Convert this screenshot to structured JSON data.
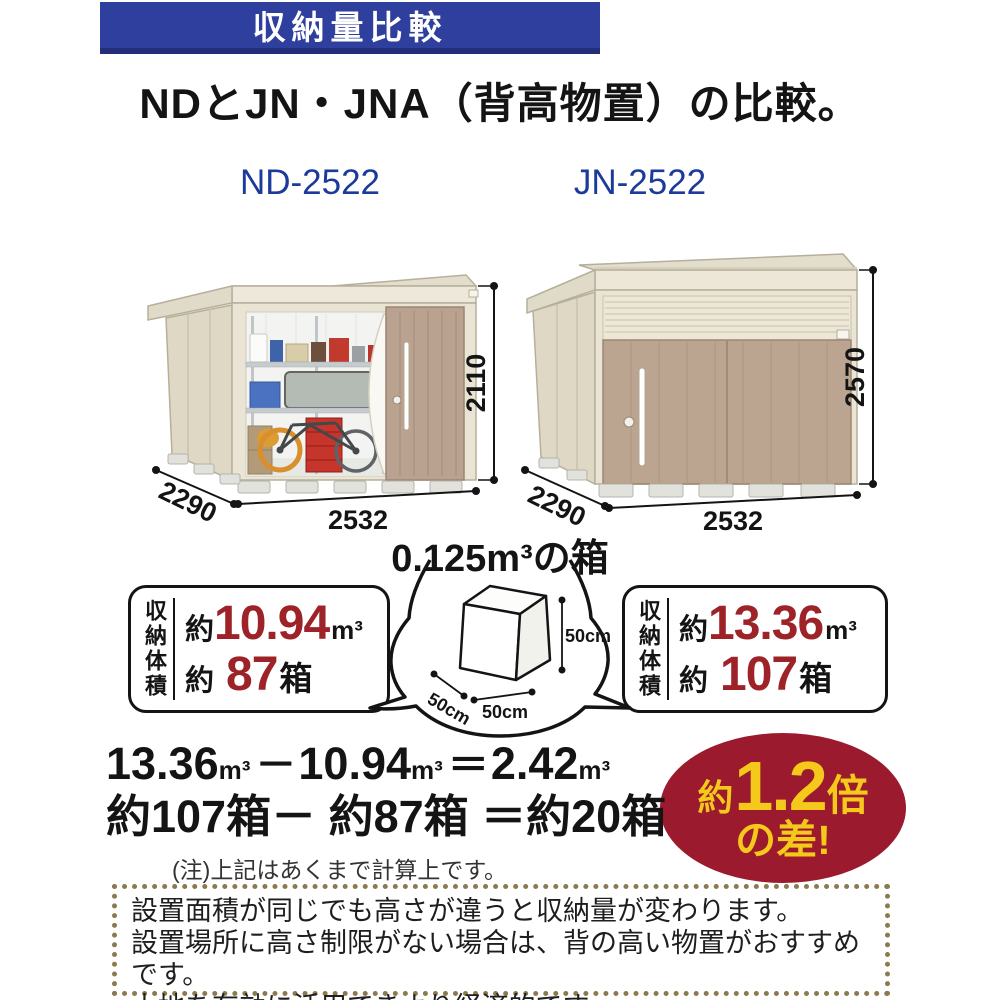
{
  "banner": {
    "title": "収納量比較"
  },
  "heading": "NDとJN・JNA（背高物置）の比較。",
  "products": {
    "nd": {
      "model": "ND-2522",
      "width": "2532",
      "depth": "2290",
      "height": "2110",
      "stat_label": "収納体積",
      "volume": {
        "approx": "約",
        "value": "10.94",
        "unit": "m³"
      },
      "boxes": {
        "approx": "約",
        "value": "87",
        "unit": "箱"
      }
    },
    "jn": {
      "model": "JN-2522",
      "width": "2532",
      "depth": "2290",
      "height": "2570",
      "stat_label": "収納体積",
      "volume": {
        "approx": "約",
        "value": "13.36",
        "unit": "m³"
      },
      "boxes": {
        "approx": "約",
        "value": "107",
        "unit": "箱"
      }
    }
  },
  "reference_box": {
    "title": "0.125m³の箱",
    "width_label": "50cm",
    "depth_label": "50cm",
    "height_label": "50cm"
  },
  "calculation": {
    "volume_line": [
      "13.36",
      "m³",
      "－",
      "10.94",
      "m³",
      "＝",
      "2.42",
      "m³"
    ],
    "boxes_line": "約107箱－ 約87箱 ＝約20箱",
    "note": "(注)上記はあくまで計算上です。"
  },
  "difference_badge": {
    "approx": "約",
    "value": "1.2",
    "times": "倍",
    "line2": "の差!"
  },
  "footer_note": {
    "lines": [
      "設置面積が同じでも高さが違うと収納量が変わります。",
      "設置場所に高さ制限がない場合は、背の高い物置がおすすめです。",
      "土地を有効に活用できより経済的です。"
    ]
  },
  "colors": {
    "banner_bg": "#2f3f9d",
    "model_label_blue": "#1b3a9a",
    "highlight_red": "#9e2328",
    "badge_bg": "#9c1a2d",
    "badge_text": "#f5c91c",
    "footer_border": "#8b7a4e"
  }
}
